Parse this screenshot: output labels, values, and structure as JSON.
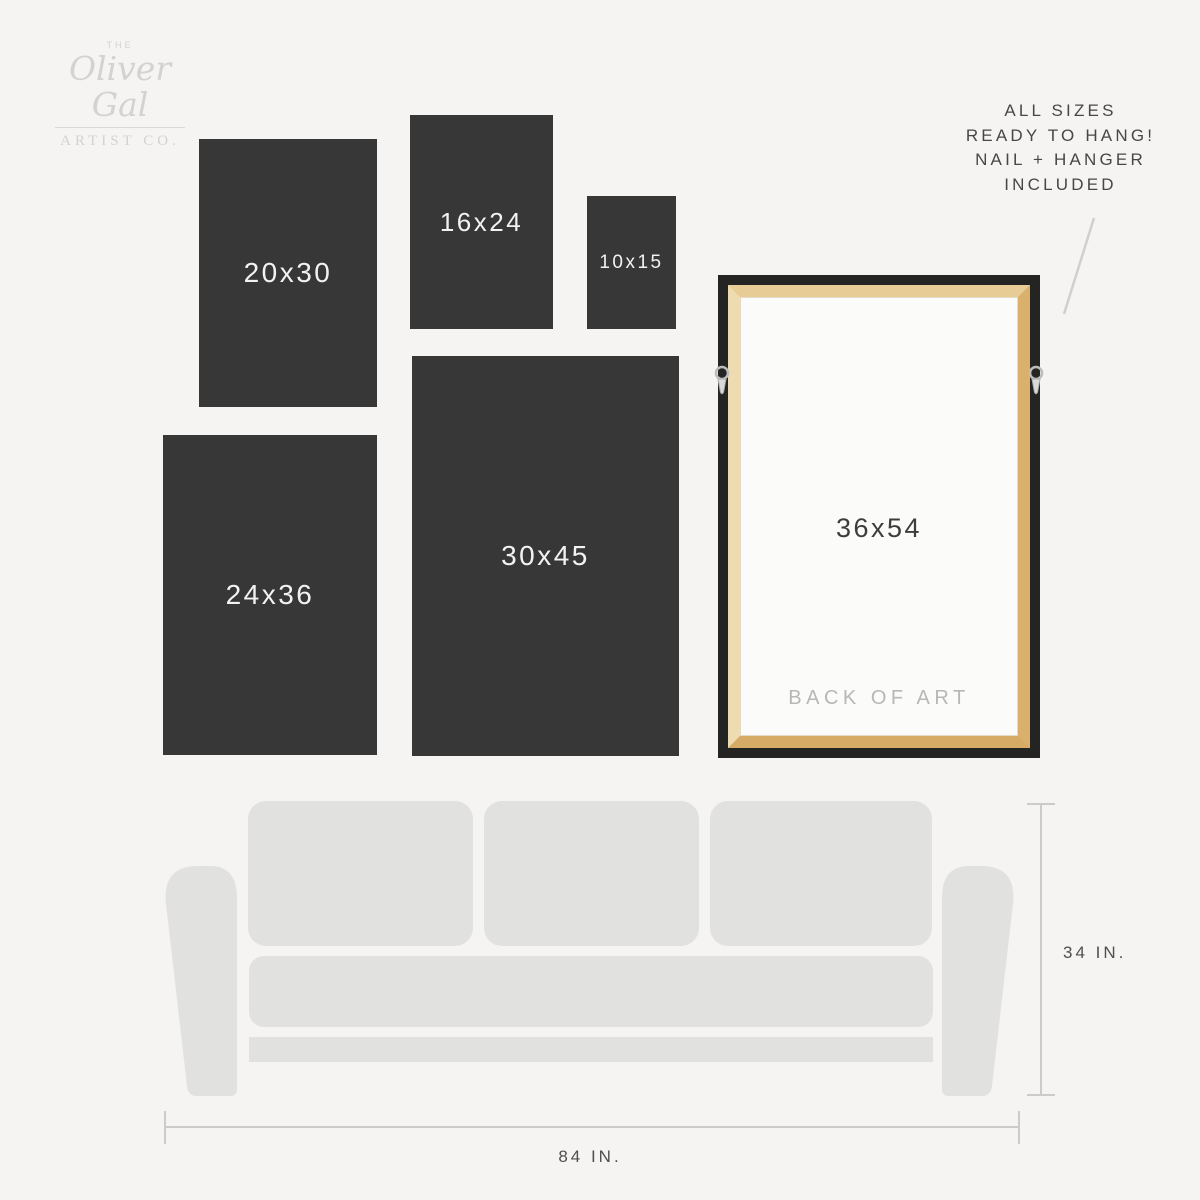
{
  "brand": {
    "the": "THE",
    "name": "Oliver Gal",
    "suffix": "ARTIST CO."
  },
  "note": {
    "lines": [
      "ALL SIZES",
      "READY TO HANG!",
      "NAIL + HANGER",
      "INCLUDED"
    ]
  },
  "sizes": [
    {
      "label": "20x30"
    },
    {
      "label": "16x24"
    },
    {
      "label": "10x15"
    },
    {
      "label": "24x36"
    },
    {
      "label": "30x45"
    }
  ],
  "frame": {
    "size_label": "36x54",
    "back_label": "BACK OF ART"
  },
  "dimensions": {
    "sofa_height": "34 IN.",
    "sofa_width": "84 IN."
  },
  "colors": {
    "background": "#f5f4f2",
    "panel_dark": "#373737",
    "panel_text": "#f2f2f2",
    "frame_black": "#242423",
    "wood_tan": "#dcb678",
    "canvas_white": "#fbfbfa",
    "sofa_gray": "#e1e1e0",
    "dim_line": "#cbcbca",
    "text_dark": "#474747",
    "logo_gray": "#d2d2d0"
  }
}
